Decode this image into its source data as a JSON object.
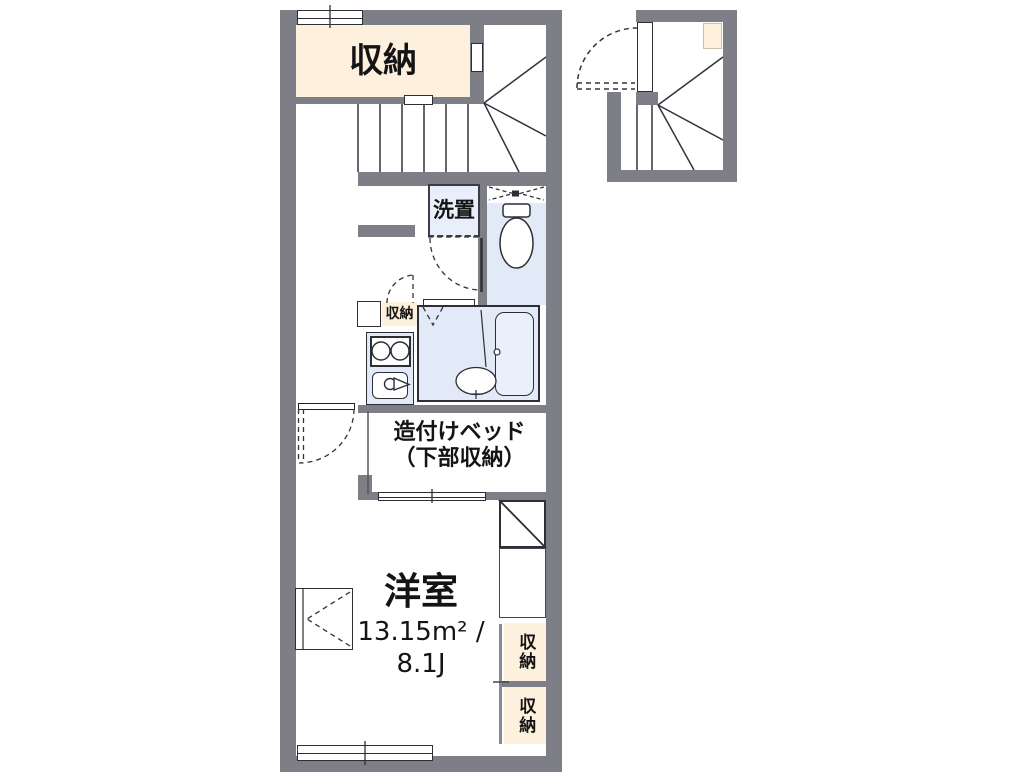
{
  "title": "apartment-floor-plan",
  "colors": {
    "wall": "#7e7e86",
    "beige": "#fdf0dc",
    "room_blue": "#e3eaf7",
    "fixture_blue": "#e9effa",
    "line": "#2e2e36"
  },
  "labels": {
    "storage_top": "収納",
    "washer": "洗置",
    "storage_hall": "収納",
    "bed_line1": "造付けベッド",
    "bed_line2": "（下部収納）",
    "room_name": "洋室",
    "room_area_m2": "13.15m² /",
    "room_area_jo": "8.1J",
    "storage_right_upper": "収納",
    "storage_right_lower": "収納"
  }
}
